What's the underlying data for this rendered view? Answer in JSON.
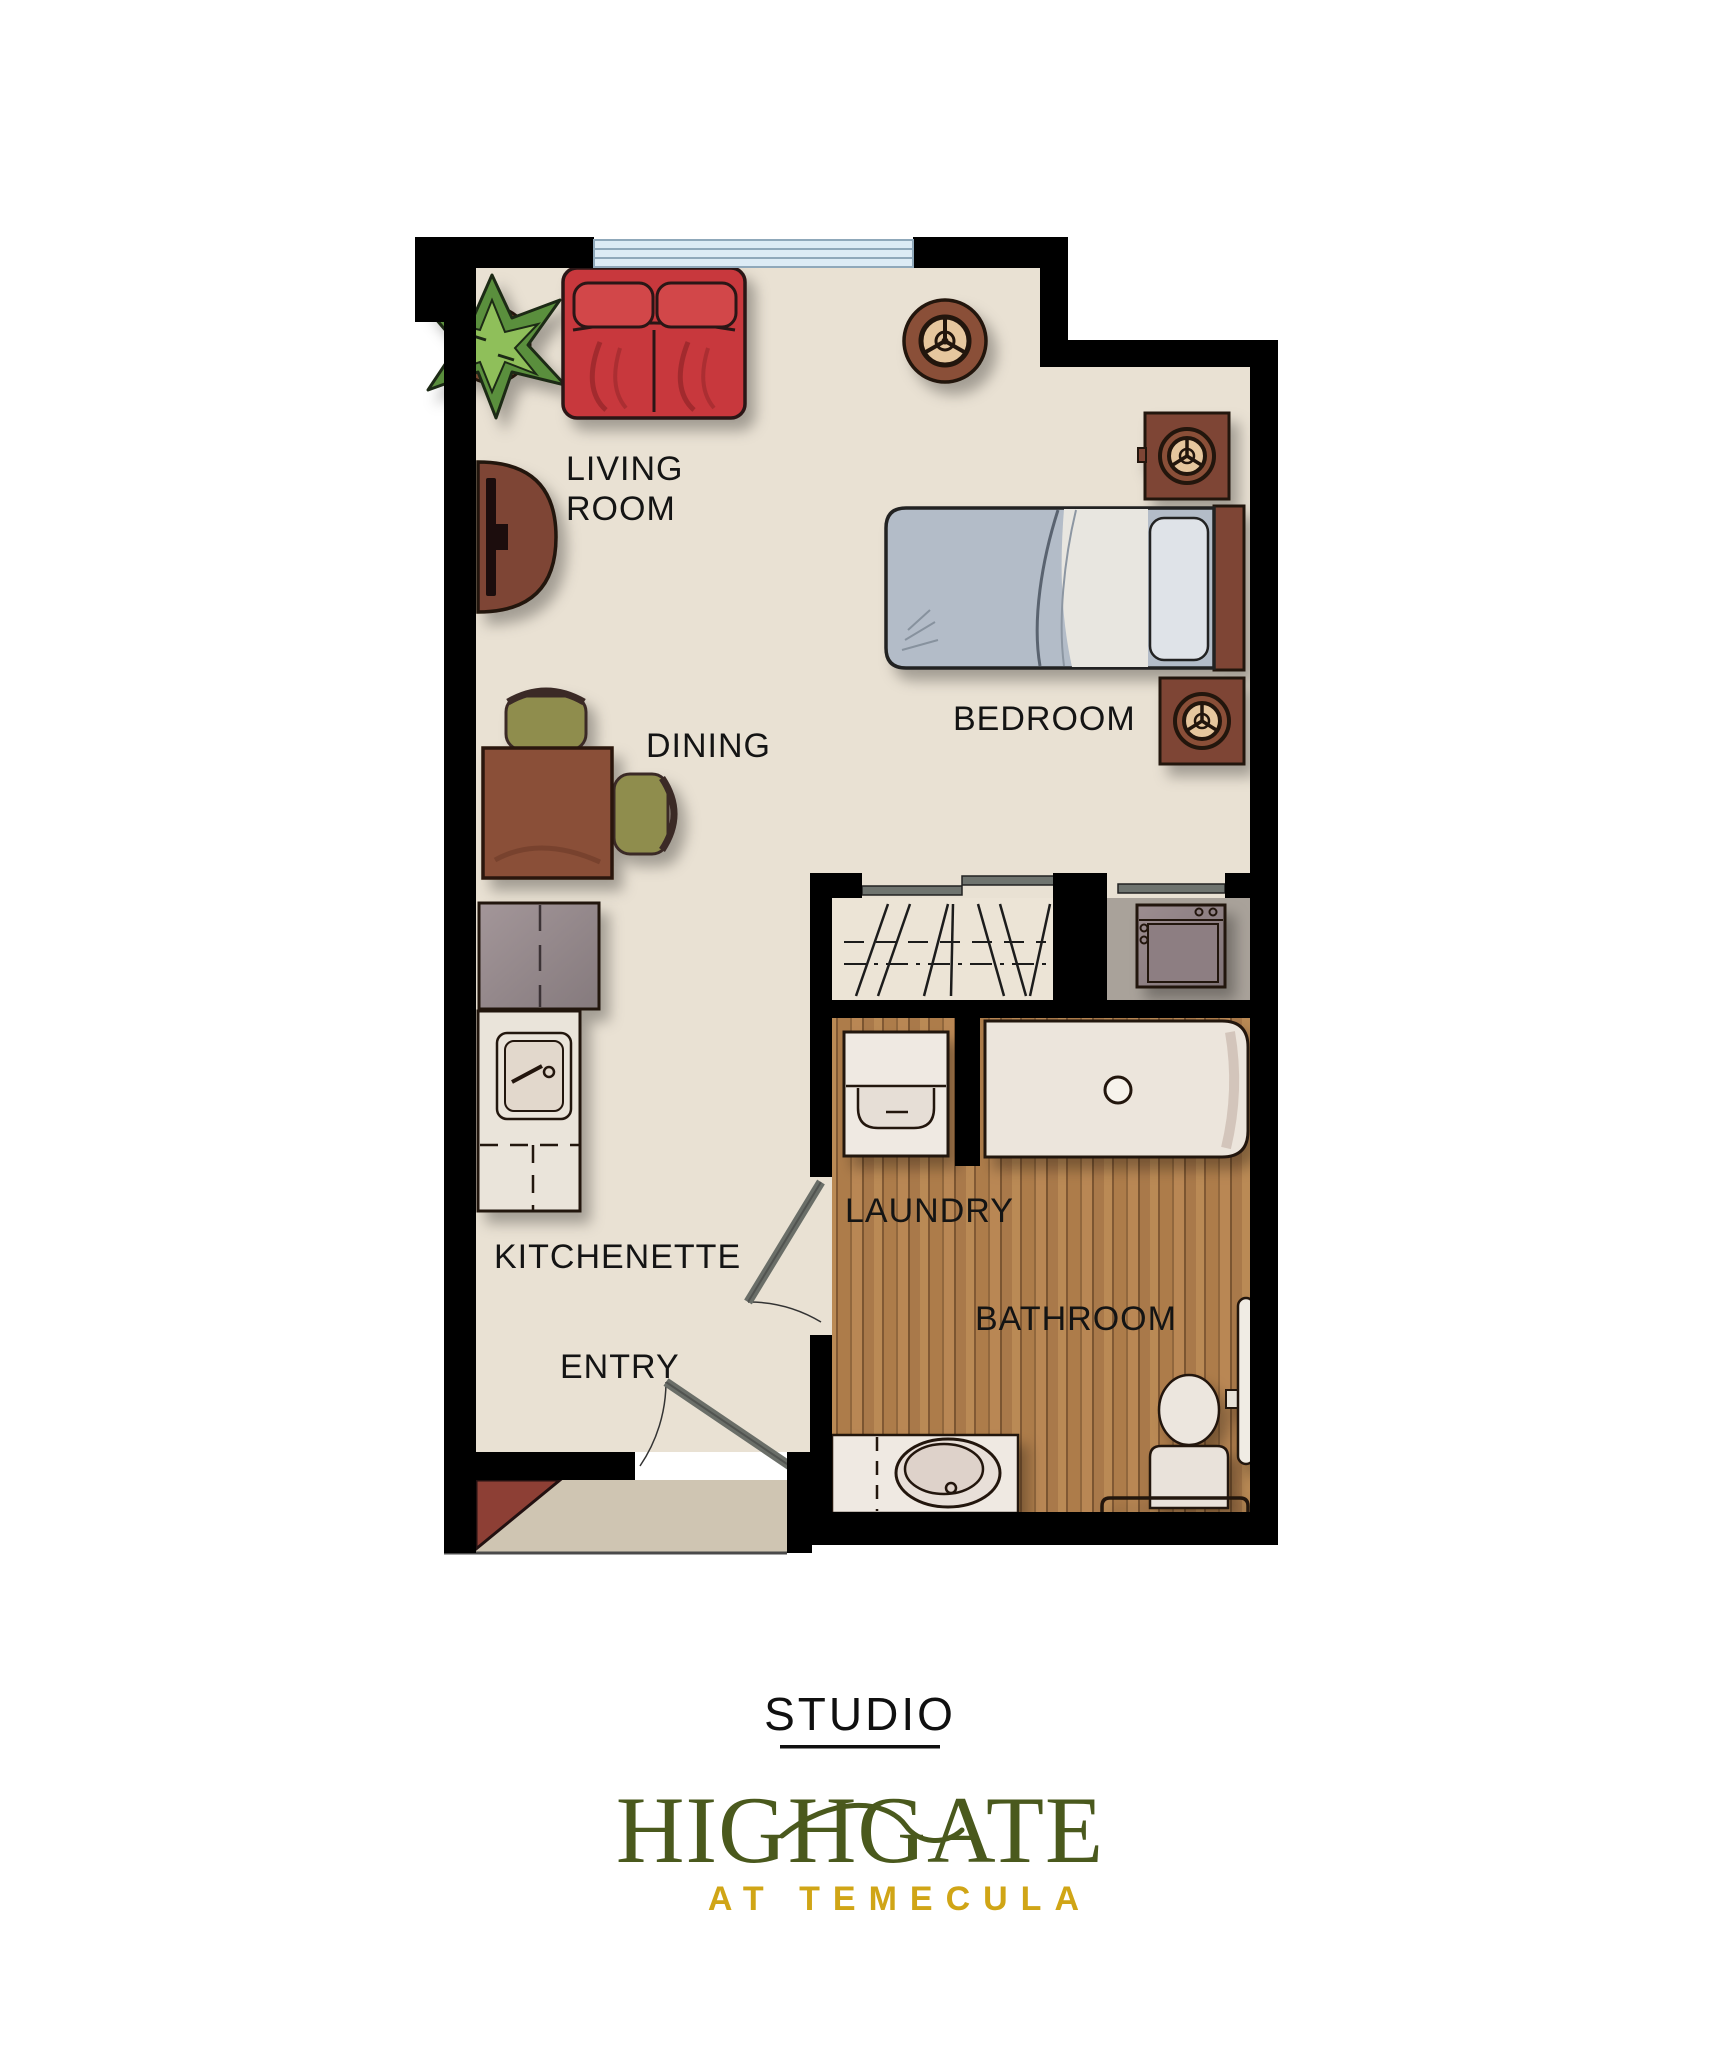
{
  "plan": {
    "title": "STUDIO",
    "brand_name": "HIGHGATE",
    "brand_tagline": "AT TEMECULA",
    "labels": {
      "living_line1": "LIVING",
      "living_line2": "ROOM",
      "dining": "DINING",
      "bedroom": "BEDROOM",
      "kitchenette": "KITCHENETTE",
      "entry": "ENTRY",
      "laundry": "LAUNDRY",
      "bathroom": "BATHROOM"
    },
    "colors": {
      "wall": "#000000",
      "floor": "#e9e1d3",
      "wood_floor": "#b1824f",
      "porch": "#cfc5b2",
      "alcove_floor": "#a9a29a",
      "window_glass": "#dcebf5",
      "sofa_red": "#c8393c",
      "furniture_brown": "#7e4534",
      "chair_green": "#8f8d4e",
      "plant_green": "#6f9c44",
      "appliance_gray": "#9c8d90",
      "fixture_white": "#ece5dc",
      "door_gray": "#6a6e68",
      "brand_green": "#4a591d",
      "brand_gold": "#d0a516",
      "label_text": "#141414"
    },
    "furniture": [
      "potted-plant",
      "loveseat-sofa",
      "round-side-table-lamp",
      "tv-console",
      "dining-table",
      "dining-chair",
      "dining-chair",
      "twin-bed",
      "nightstand-lamp",
      "nightstand-lamp",
      "refrigerator",
      "kitchen-sink-counter",
      "closet-hanging-rod",
      "sliding-closet-doors",
      "stacked-washer-dryer",
      "washer",
      "bathtub",
      "vanity-sink",
      "toilet",
      "grab-bar",
      "entry-door",
      "bathroom-door",
      "window"
    ]
  }
}
